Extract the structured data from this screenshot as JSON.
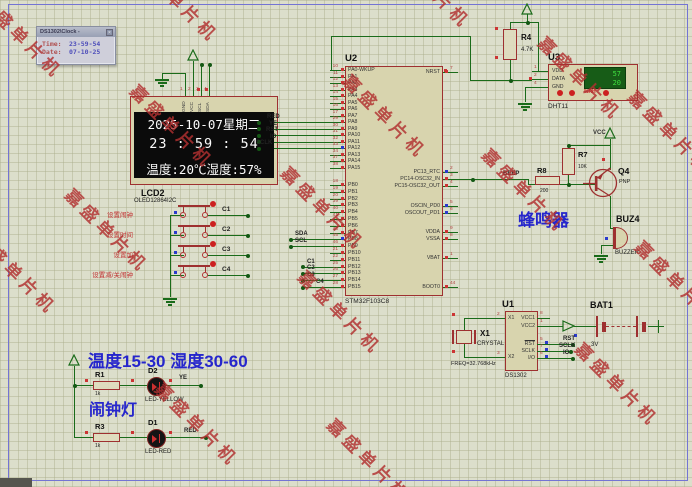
{
  "watermark": {
    "text": "嘉盛单片机",
    "color": "#b23030"
  },
  "popup": {
    "title": "DS1302\\Clock -",
    "close_glyph": "×",
    "time_label": "Time:",
    "time_value": "23-59-54",
    "date_label": "Date:",
    "date_value": "07-10-25"
  },
  "lcd": {
    "ref": "LCD2",
    "part": "OLED12864I2C",
    "pin_numbers": [
      "1",
      "2",
      "3",
      "4"
    ],
    "pin_names": [
      "GND",
      "VCC",
      "SCL",
      "SDA"
    ],
    "lines": [
      "2025-10-07星期二",
      "23 : 59 : 54",
      "温度:20℃湿度:57%"
    ]
  },
  "keys": {
    "items": [
      {
        "label": "设置闹钟",
        "net": "C1"
      },
      {
        "label": "设置时间",
        "net": "C2"
      },
      {
        "label": "设置加",
        "net": "C3"
      },
      {
        "label": "设置减/关闹钟",
        "net": "C4"
      }
    ]
  },
  "mcu": {
    "ref": "U2",
    "part": "STM32F103C8",
    "left_pins": [
      {
        "num": "10",
        "name": "PA0-WKUP"
      },
      {
        "num": "11",
        "name": "PA1"
      },
      {
        "num": "12",
        "name": "PA2"
      },
      {
        "num": "13",
        "name": "PA3"
      },
      {
        "num": "14",
        "name": "PA4"
      },
      {
        "num": "15",
        "name": "PA5"
      },
      {
        "num": "16",
        "name": "PA6"
      },
      {
        "num": "17",
        "name": "PA7"
      },
      {
        "num": "29",
        "name": "PA8"
      },
      {
        "num": "30",
        "name": "PA9"
      },
      {
        "num": "31",
        "name": "PA10"
      },
      {
        "num": "32",
        "name": "PA11"
      },
      {
        "num": "33",
        "name": "PA12"
      },
      {
        "num": "34",
        "name": "PA13"
      },
      {
        "num": "37",
        "name": "PA14"
      },
      {
        "num": "38",
        "name": "PA15"
      },
      {
        "num": "18",
        "name": "PB0"
      },
      {
        "num": "19",
        "name": "PB1"
      },
      {
        "num": "20",
        "name": "PB2"
      },
      {
        "num": "39",
        "name": "PB3"
      },
      {
        "num": "40",
        "name": "PB4"
      },
      {
        "num": "41",
        "name": "PB5"
      },
      {
        "num": "42",
        "name": "PB6"
      },
      {
        "num": "43",
        "name": "PB7"
      },
      {
        "num": "45",
        "name": "PB8"
      },
      {
        "num": "46",
        "name": "PB9"
      },
      {
        "num": "21",
        "name": "PB10"
      },
      {
        "num": "22",
        "name": "PB11"
      },
      {
        "num": "25",
        "name": "PB12"
      },
      {
        "num": "26",
        "name": "PB13"
      },
      {
        "num": "27",
        "name": "PB14"
      },
      {
        "num": "28",
        "name": "PB15"
      }
    ],
    "right_pins": [
      {
        "num": "7",
        "name": "NRST"
      },
      {
        "num": "2",
        "name": "PC13_RTC"
      },
      {
        "num": "3",
        "name": "PC14-OSC32_IN"
      },
      {
        "num": "4",
        "name": "PC15-OSC32_OUT"
      },
      {
        "num": "5",
        "name": "OSCIN_PD0"
      },
      {
        "num": "6",
        "name": "OSCOUT_PD1"
      },
      {
        "num": "9",
        "name": "VDDA"
      },
      {
        "num": "8",
        "name": "VSSA"
      },
      {
        "num": "1",
        "name": "VBAT"
      },
      {
        "num": "44",
        "name": "BOOT0"
      }
    ],
    "left_nets": [
      "RED",
      "YE",
      "RST",
      "IO",
      "SCLK"
    ],
    "i2c_nets": [
      "SDA",
      "SCL"
    ],
    "key_nets": [
      "C1",
      "C2",
      "C3",
      "C4"
    ],
    "beep_net": "BEEP"
  },
  "dht": {
    "ref": "U3",
    "part": "DHT11",
    "pins": [
      {
        "num": "1",
        "name": "VDD"
      },
      {
        "num": "2",
        "name": "DATA"
      },
      {
        "num": "4",
        "name": "GND"
      }
    ],
    "humidity": "57",
    "temperature": "20",
    "rh_label": "%RH"
  },
  "r4": {
    "ref": "R4",
    "value": "4.7K"
  },
  "buzzer": {
    "vcc_label": "VCC",
    "r7_ref": "R7",
    "r7_value": "10K",
    "r8_ref": "R8",
    "r8_value": "200",
    "q_ref": "Q4",
    "q_type": "PNP",
    "buz_ref": "BUZ4",
    "buz_part": "BUZZER",
    "caption": "蜂鸣器"
  },
  "rtc": {
    "ref": "U1",
    "part": "DS1302",
    "left_pins": [
      {
        "num": "2",
        "name": "X1"
      },
      {
        "num": "3",
        "name": "X2"
      }
    ],
    "right_pins": [
      {
        "num": "8",
        "name": "VCC1"
      },
      {
        "num": "1",
        "name": "VCC2"
      },
      {
        "num": "5",
        "name": "RST"
      },
      {
        "num": "7",
        "name": "SCLK"
      },
      {
        "num": "6",
        "name": "I/O"
      }
    ],
    "net_labels": [
      "RST",
      "SCLK",
      "IO"
    ],
    "crystal": {
      "ref": "X1",
      "part": "CRYSTAL",
      "freq": "FREQ=32.768kHz"
    },
    "battery": {
      "ref": "BAT1",
      "voltage": "3V"
    }
  },
  "alarm": {
    "caption_range": "温度15-30  湿度30-60",
    "caption_lamp": "闹钟灯",
    "rows": [
      {
        "r_ref": "R1",
        "r_value": "1k",
        "d_ref": "D2",
        "d_part": "LED-YELLOW",
        "net": "YE"
      },
      {
        "r_ref": "R3",
        "r_value": "1k",
        "d_ref": "D1",
        "d_part": "LED-RED",
        "net": "RED"
      }
    ]
  }
}
